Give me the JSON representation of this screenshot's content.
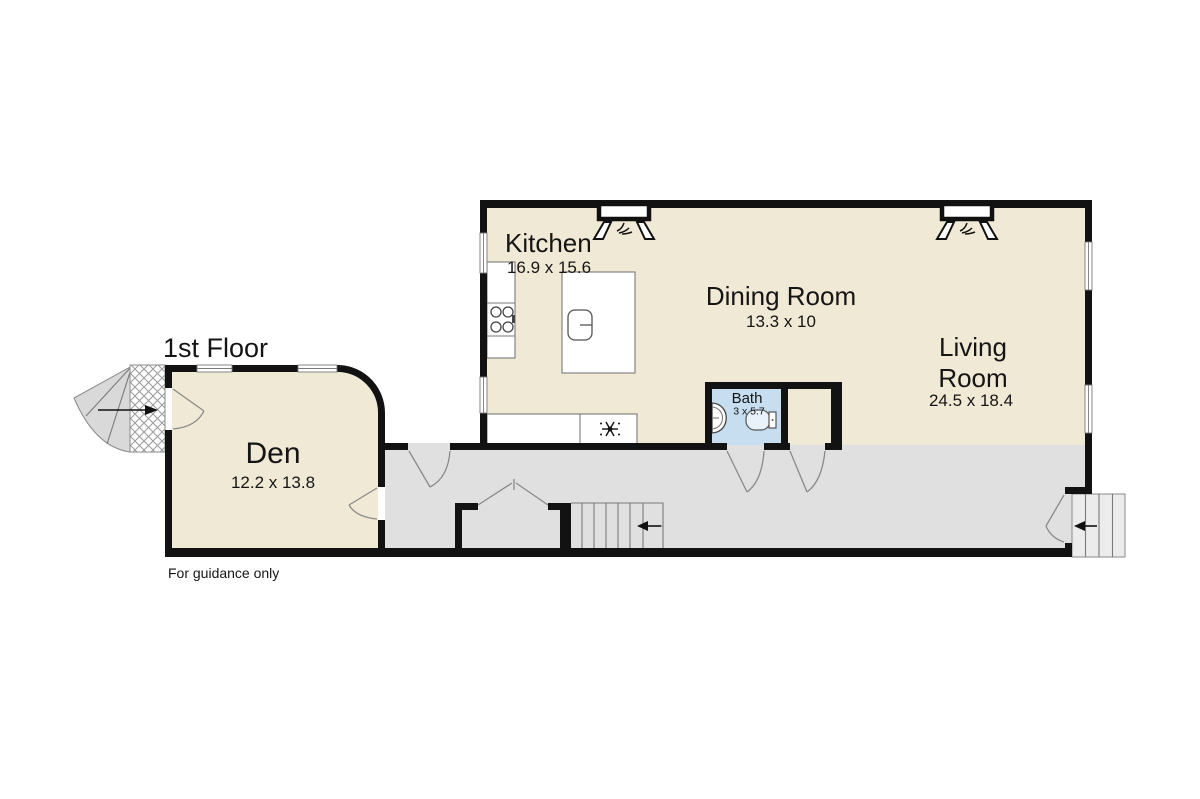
{
  "floor_plan": {
    "title": "1st Floor",
    "disclaimer": "For guidance only",
    "rooms": {
      "kitchen": {
        "name": "Kitchen",
        "dimensions": "16.9 x 15.6"
      },
      "dining_room": {
        "name": "Dining Room",
        "dimensions": "13.3 x 10"
      },
      "living_room": {
        "name_line1": "Living",
        "name_line2": "Room",
        "dimensions": "24.5 x 18.4"
      },
      "den": {
        "name": "Den",
        "dimensions": "12.2 x 13.8"
      },
      "bath": {
        "name": "Bath",
        "dimensions": "3 x 5.7"
      }
    }
  },
  "colors": {
    "wall": "#121212",
    "floor": "#f0e9d5",
    "hall": "#e0e0e0",
    "bathFloor": "#c6def0",
    "steps": "#ececec",
    "fanSteps": "#d9d9d9"
  }
}
